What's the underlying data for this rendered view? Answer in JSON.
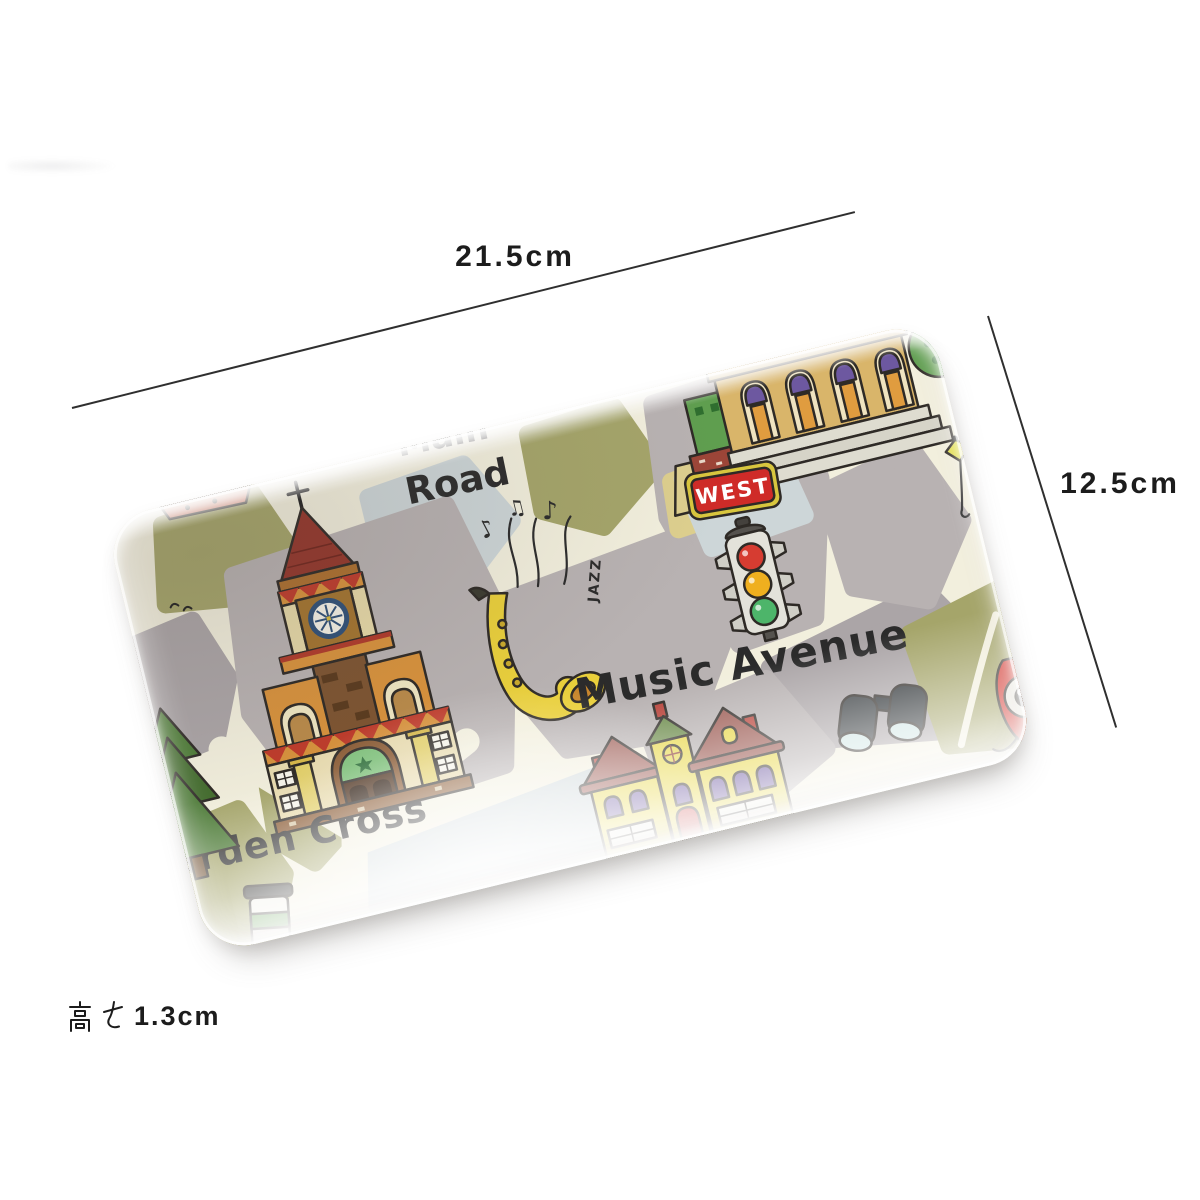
{
  "annotations": {
    "width_label": "21.5cm",
    "height_label": "12.5cm",
    "depth_label": "高さ 1.3cm",
    "depth_value": "1.3cm"
  },
  "tray": {
    "street_names": {
      "top_partial": "Main",
      "road": "Road",
      "avenue": "Music Avenue",
      "cross": "Garden Cross"
    },
    "signs": {
      "west": "WEST",
      "jazz": "JAZZ"
    },
    "icons": {
      "note1": "♪",
      "note2": "♫",
      "note3": "♪"
    },
    "illustrations": [
      "church-with-clock-tower",
      "classical-building-with-steps",
      "traffic-light",
      "saxophone",
      "music-notes",
      "two-story-house",
      "binoculars",
      "camera",
      "street-lamp",
      "pine-tree",
      "coffee-cup",
      "green-bush",
      "west-sign"
    ]
  },
  "colors": {
    "road_cream": "#f2efdd",
    "block_gray": "#b8b2b2",
    "block_gray2": "#aba5a7",
    "block_olive": "#a5a56a",
    "block_blue": "#cdd6d8",
    "block_khaki": "#ddcf8e",
    "outline": "#2e2a26",
    "text_dark": "#2b2b2b",
    "sign_red": "#cf2b28",
    "sign_yellow": "#d8c63e",
    "light_red": "#d63c31",
    "light_yellow": "#efaf1f",
    "light_green": "#4db56a",
    "sax_yellow": "#e9cf3b",
    "church_orange": "#d8923c",
    "church_red": "#bf3b2b",
    "roof_brown": "#9c5a52",
    "house_yellow": "#e8d84a",
    "window_purple": "#6d58a0",
    "building_tan": "#d9b56a",
    "green_dark": "#5f9e4f",
    "camera_red": "#d43028",
    "line_color": "#2f2f2f"
  }
}
